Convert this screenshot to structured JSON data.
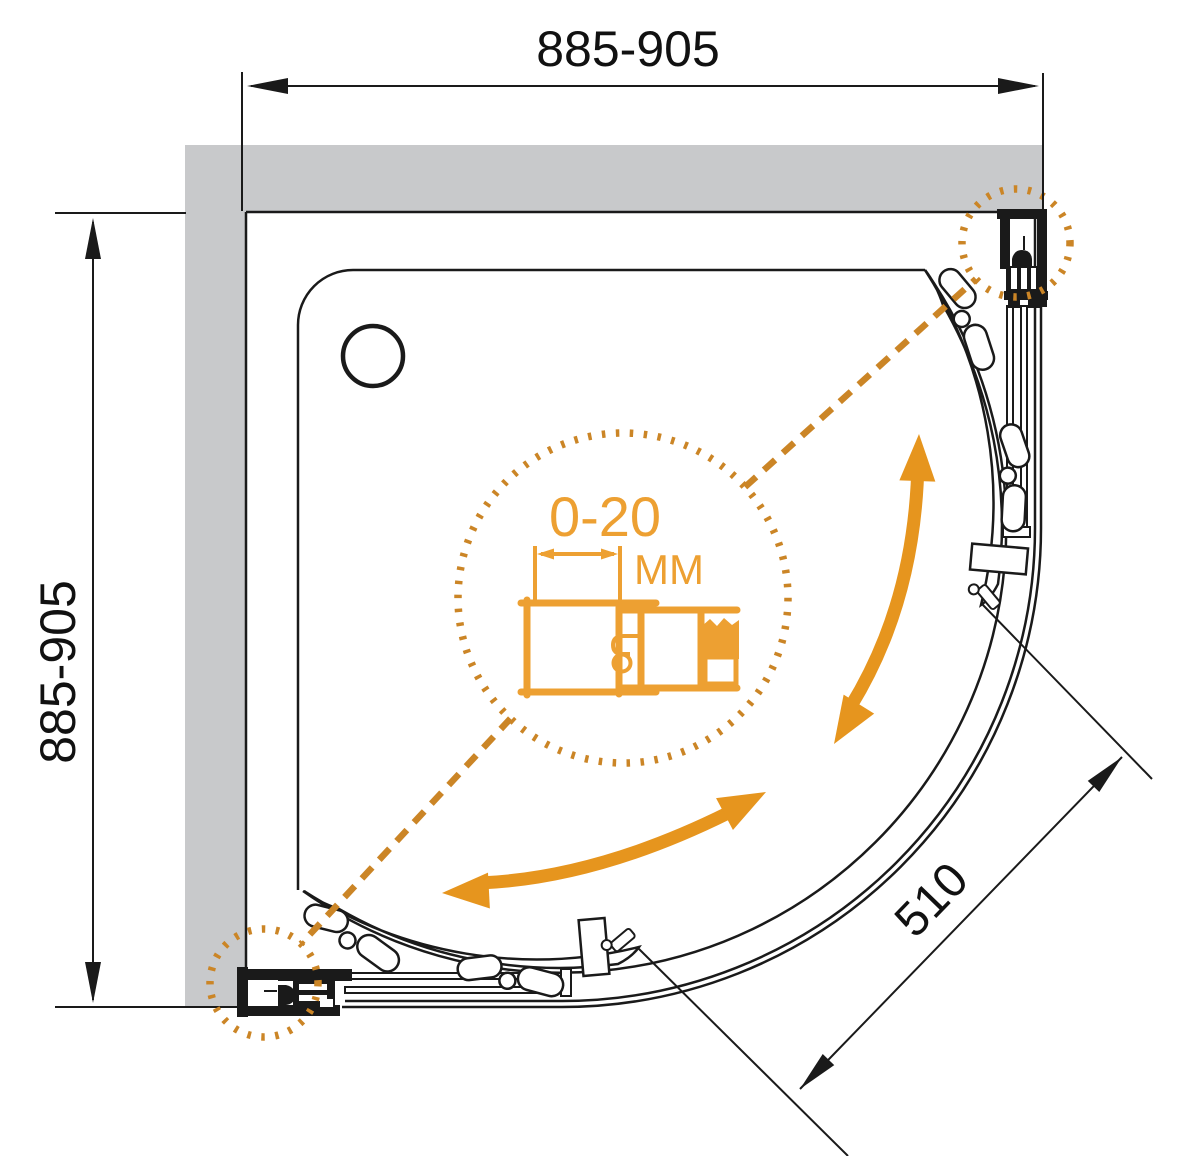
{
  "drawing": {
    "type": "shower-enclosure-plan-technical-drawing",
    "dimensions": {
      "width_top": "885-905",
      "depth_left": "885-905",
      "entry_diagonal": "510",
      "adjustment_range": "0-20",
      "adjustment_unit": "MM"
    },
    "colors": {
      "orange": "#E6951E",
      "orange_dots": "#CB8526",
      "orange_profile": "#EDA032",
      "wall_gray": "#C8C9CB",
      "line": "#1A1A1A"
    }
  }
}
